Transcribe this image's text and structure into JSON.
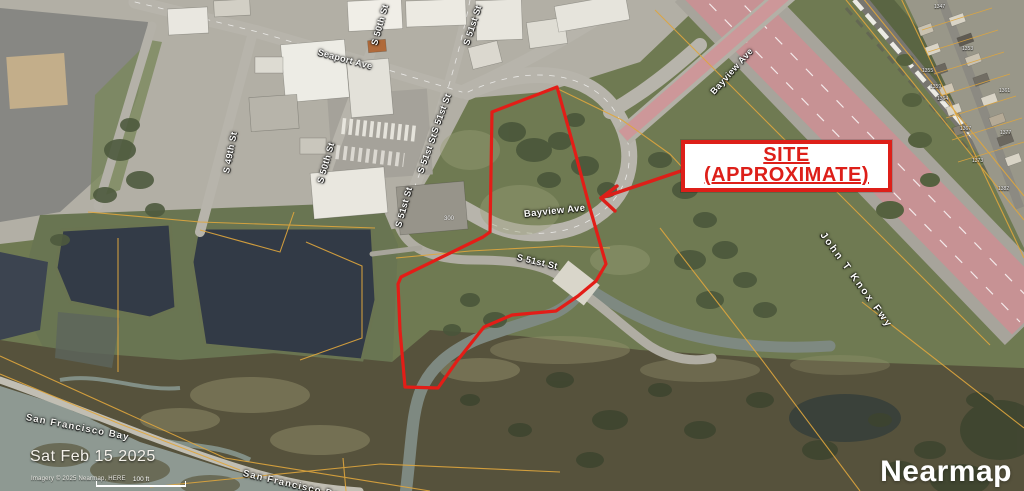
{
  "annotation": {
    "site_line1": "SITE",
    "site_line2": "(APPROXIMATE)"
  },
  "roads": {
    "seaport_ave": "Seaport Ave",
    "s_49th_st": "S 49th St",
    "s_50th_st": "S 50th St",
    "s_51st_st": "S 51st St",
    "bayview_ave": "Bayview Ave",
    "john_t_knox_fwy": "John T Knox Fwy"
  },
  "water": {
    "san_francisco_bay": "San Francisco Bay"
  },
  "parcels": {
    "building_number": "300",
    "numbers": [
      "1347",
      "1353",
      "1355",
      "1359",
      "1361",
      "1364",
      "1367",
      "1373",
      "1377",
      "1382"
    ]
  },
  "footer": {
    "date": "Sat Feb 15 2025",
    "attribution": "Imagery © 2025 Nearmap, HERE",
    "scale_label": "100 ft"
  },
  "branding": {
    "logo": "Nearmap"
  },
  "colors": {
    "site_outline": "#e31d17",
    "parcel_line": "#dfa63d",
    "freeway_highlight": "#e2838e",
    "annotation_red": "#dd1f19"
  }
}
